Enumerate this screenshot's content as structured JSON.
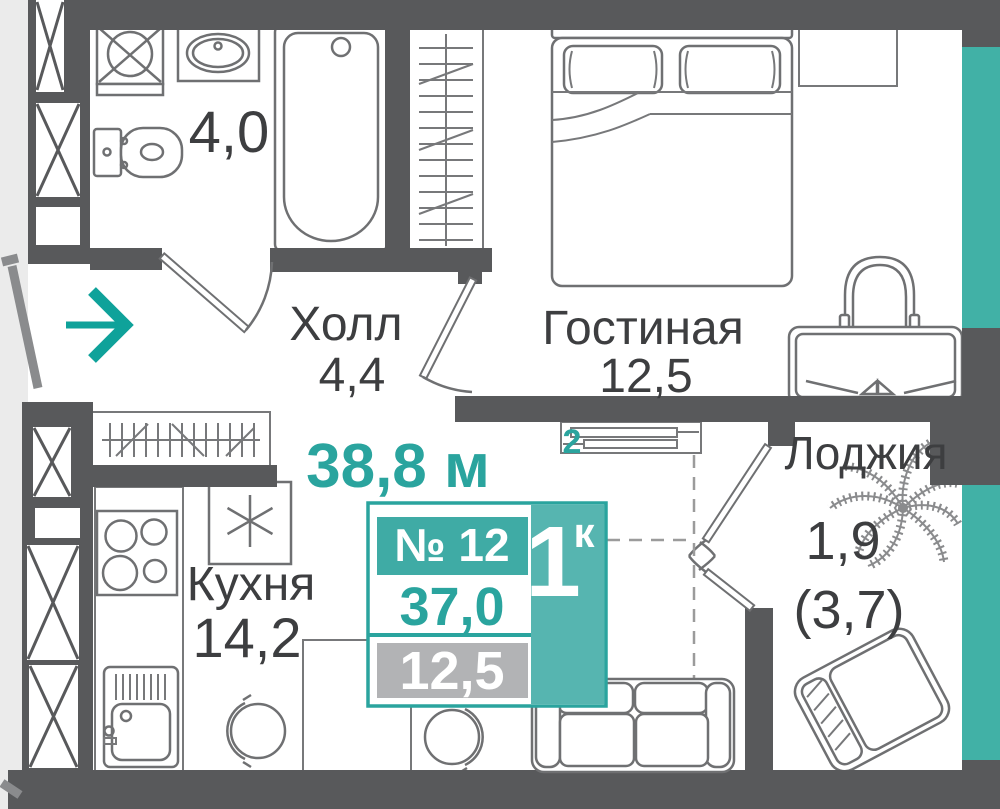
{
  "floor_plan": {
    "rooms": {
      "bathroom": {
        "area": "4,0"
      },
      "hall": {
        "name": "Холл",
        "area": "4,4"
      },
      "living_room": {
        "name": "Гостиная",
        "area": "12,5"
      },
      "kitchen": {
        "name": "Кухня",
        "area": "14,2"
      },
      "loggia": {
        "name": "Лоджия",
        "area": "1,9",
        "area_full": "(3,7)"
      }
    },
    "info_card": {
      "total_area": "38,8 м",
      "total_area_sup": "2",
      "apartment_number": "№ 12",
      "rooms_label": "1",
      "rooms_label_sup": "к",
      "area_no_loggia": "37,0",
      "living_area": "12,5"
    },
    "colors": {
      "accent_teal": "#2aa49e",
      "fill_teal": "#3faba5",
      "window_teal": "#41b1a6",
      "wall_gray": "#58595b",
      "area_box_gray": "#b2b3b5",
      "outside_gray": "#ebebeb"
    },
    "icons": [
      "washing-machine-icon",
      "bathroom-sink-icon",
      "toilet-icon",
      "bathtub-icon",
      "wardrobe-icon",
      "coat-rack-icon",
      "double-bed-icon",
      "nightstand-icon",
      "desk-chair-icon",
      "dressing-table-icon",
      "tv-console-icon",
      "stove-icon",
      "fridge-icon",
      "kitchen-sink-icon",
      "kitchen-counter-icon",
      "dining-table-icon",
      "stool-icon",
      "sofa-icon",
      "armchair-icon",
      "palm-plant-icon",
      "entrance-arrow-icon"
    ]
  }
}
